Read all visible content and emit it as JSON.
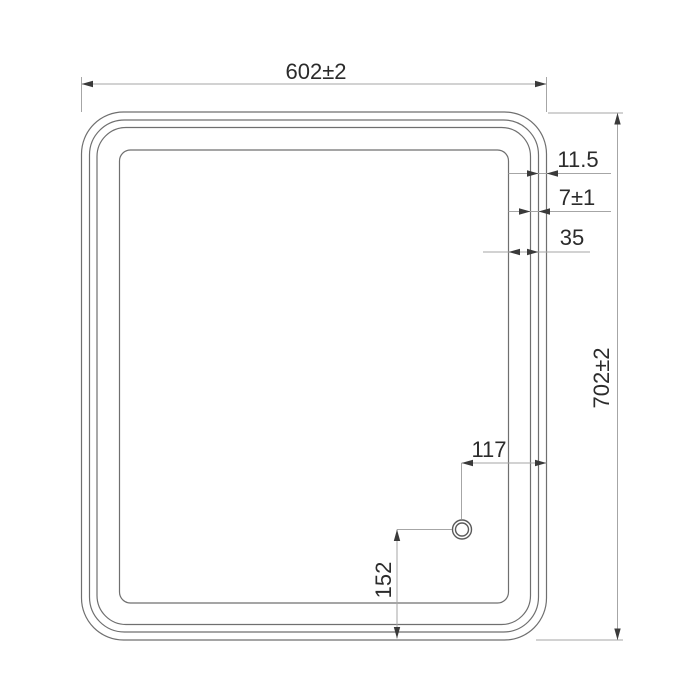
{
  "colors": {
    "line": "#6f6f6f",
    "sensor_line": "#5a5a5a",
    "dim_line": "#a6a6a6",
    "arrow": "#3a3a3a",
    "text": "#2b2b2b",
    "background": "#ffffff"
  },
  "dimensions": {
    "overall_width": "602±2",
    "overall_height": "702±2",
    "edge_to_second_line": "11.5",
    "second_to_third_line": "7±1",
    "edge_band_total": "35",
    "sensor_from_right": "117",
    "sensor_from_bottom": "152"
  }
}
